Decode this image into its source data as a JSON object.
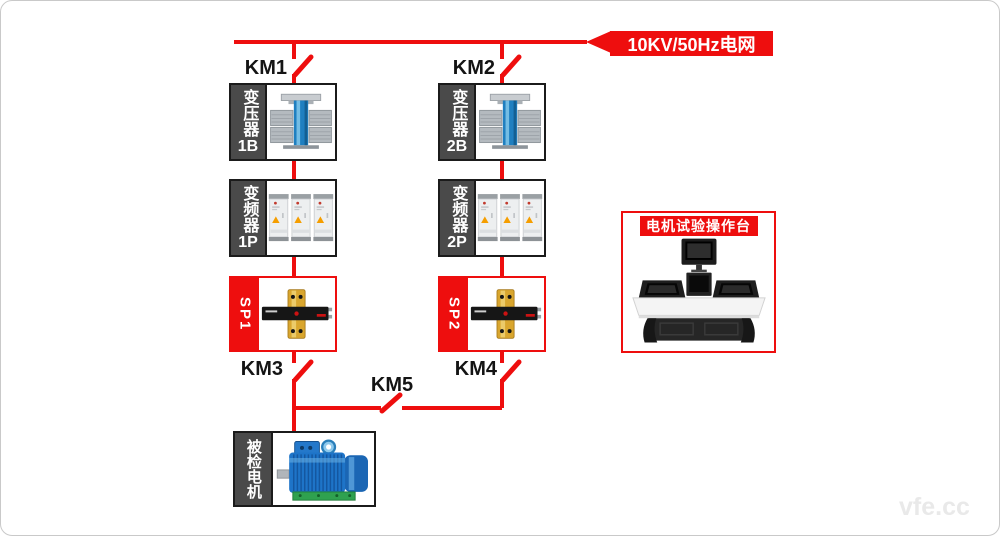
{
  "grid": {
    "label": "10KV/50Hz电网"
  },
  "switches": {
    "km1": "KM1",
    "km2": "KM2",
    "km3": "KM3",
    "km4": "KM4",
    "km5": "KM5"
  },
  "branch1": {
    "transformer_label": "变压器",
    "transformer_code": "1B",
    "inverter_label": "变频器",
    "inverter_code": "1P",
    "sensor_label": "SP1"
  },
  "branch2": {
    "transformer_label": "变压器",
    "transformer_code": "2B",
    "inverter_label": "变频器",
    "inverter_code": "2P",
    "sensor_label": "SP2"
  },
  "motor": {
    "label": "被检电机"
  },
  "console": {
    "title": "电机试验操作台"
  },
  "watermark": "vfe.cc",
  "colors": {
    "red": "#ee0e0e",
    "sidebar": "#4a4a4a",
    "border": "#1b1b1b"
  }
}
